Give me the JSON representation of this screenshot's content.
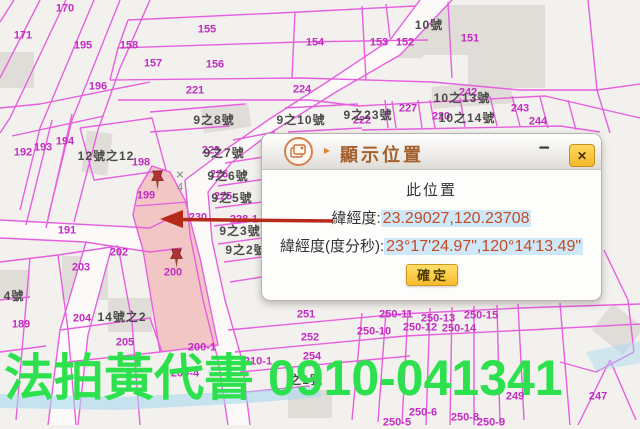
{
  "dialog": {
    "title": "顯示位置",
    "title_arrow_glyph": "▸",
    "icon": "show-position-icon",
    "minimize_glyph": "−",
    "close_glyph": "✕",
    "body": {
      "heading": "此位置",
      "latlng_label": "緯經度:",
      "latlng_value": "23.29027,120.23708",
      "dms_label": "緯經度(度分秒):",
      "dms_value": "23°17'24.97\",120°14'13.49\"",
      "confirm_label": "確定"
    }
  },
  "ad_banner": {
    "text": "法拍黃代書 0910-041341",
    "color": "#2de14e"
  },
  "map": {
    "colors": {
      "parcel_line": "#e65fdf",
      "parcel_number": "#c32cc3",
      "house_label": "#4a4a4a",
      "selected_parcel_fill": "#f3c6c6",
      "river": "#a8d8f0",
      "building": "#e0ddd9",
      "arrow": "#b52a18"
    },
    "road_marker": {
      "x": 180,
      "y": 182,
      "top": "✕",
      "bottom": "4"
    },
    "pins": [
      {
        "x": 157,
        "y": 183
      },
      {
        "x": 176,
        "y": 261
      }
    ],
    "labels": [
      {
        "t": "170",
        "x": 65,
        "y": 9,
        "k": "p"
      },
      {
        "t": "171",
        "x": 23,
        "y": 36,
        "k": "p"
      },
      {
        "t": "195",
        "x": 83,
        "y": 46,
        "k": "p"
      },
      {
        "t": "158",
        "x": 129,
        "y": 46,
        "k": "p"
      },
      {
        "t": "157",
        "x": 153,
        "y": 64,
        "k": "p"
      },
      {
        "t": "196",
        "x": 98,
        "y": 87,
        "k": "p"
      },
      {
        "t": "155",
        "x": 207,
        "y": 30,
        "k": "p"
      },
      {
        "t": "156",
        "x": 215,
        "y": 65,
        "k": "p"
      },
      {
        "t": "154",
        "x": 315,
        "y": 43,
        "k": "p"
      },
      {
        "t": "153",
        "x": 379,
        "y": 43,
        "k": "p"
      },
      {
        "t": "152",
        "x": 405,
        "y": 43,
        "k": "p"
      },
      {
        "t": "151",
        "x": 470,
        "y": 39,
        "k": "p"
      },
      {
        "t": "221",
        "x": 195,
        "y": 91,
        "k": "p"
      },
      {
        "t": "224",
        "x": 302,
        "y": 90,
        "k": "p"
      },
      {
        "t": "227",
        "x": 408,
        "y": 109,
        "k": "p"
      },
      {
        "t": "242",
        "x": 468,
        "y": 93,
        "k": "p"
      },
      {
        "t": "243",
        "x": 520,
        "y": 109,
        "k": "p"
      },
      {
        "t": "244",
        "x": 538,
        "y": 122,
        "k": "p"
      },
      {
        "t": "222",
        "x": 362,
        "y": 121,
        "k": "p"
      },
      {
        "t": "220",
        "x": 441,
        "y": 117,
        "k": "p"
      },
      {
        "t": "192",
        "x": 23,
        "y": 153,
        "k": "p"
      },
      {
        "t": "193",
        "x": 43,
        "y": 148,
        "k": "p"
      },
      {
        "t": "194",
        "x": 65,
        "y": 142,
        "k": "p"
      },
      {
        "t": "198",
        "x": 141,
        "y": 163,
        "k": "p"
      },
      {
        "t": "199",
        "x": 146,
        "y": 196,
        "k": "p"
      },
      {
        "t": "191",
        "x": 67,
        "y": 231,
        "k": "p"
      },
      {
        "t": "202",
        "x": 119,
        "y": 253,
        "k": "p"
      },
      {
        "t": "203",
        "x": 81,
        "y": 268,
        "k": "p"
      },
      {
        "t": "204",
        "x": 82,
        "y": 319,
        "k": "p"
      },
      {
        "t": "205",
        "x": 125,
        "y": 343,
        "k": "p"
      },
      {
        "t": "189",
        "x": 21,
        "y": 325,
        "k": "p"
      },
      {
        "t": "200",
        "x": 173,
        "y": 273,
        "k": "p"
      },
      {
        "t": "200-1",
        "x": 202,
        "y": 348,
        "k": "p"
      },
      {
        "t": "200-4",
        "x": 185,
        "y": 374,
        "k": "p"
      },
      {
        "t": "210-1",
        "x": 258,
        "y": 362,
        "k": "p"
      },
      {
        "t": "251",
        "x": 306,
        "y": 315,
        "k": "p"
      },
      {
        "t": "252",
        "x": 310,
        "y": 338,
        "k": "p"
      },
      {
        "t": "254",
        "x": 312,
        "y": 357,
        "k": "p"
      },
      {
        "t": "250-10",
        "x": 374,
        "y": 332,
        "k": "p"
      },
      {
        "t": "250-11",
        "x": 396,
        "y": 315,
        "k": "p"
      },
      {
        "t": "250-12",
        "x": 420,
        "y": 328,
        "k": "p"
      },
      {
        "t": "250-13",
        "x": 438,
        "y": 319,
        "k": "p"
      },
      {
        "t": "250-14",
        "x": 459,
        "y": 329,
        "k": "p"
      },
      {
        "t": "250-15",
        "x": 481,
        "y": 316,
        "k": "p"
      },
      {
        "t": "250-6",
        "x": 423,
        "y": 413,
        "k": "p"
      },
      {
        "t": "250-5",
        "x": 397,
        "y": 423,
        "k": "p"
      },
      {
        "t": "250-8",
        "x": 465,
        "y": 418,
        "k": "p"
      },
      {
        "t": "250-9",
        "x": 491,
        "y": 423,
        "k": "p"
      },
      {
        "t": "249",
        "x": 515,
        "y": 397,
        "k": "p"
      },
      {
        "t": "247",
        "x": 598,
        "y": 397,
        "k": "p"
      },
      {
        "t": "230",
        "x": 198,
        "y": 218,
        "k": "p"
      },
      {
        "t": "228-1",
        "x": 244,
        "y": 220,
        "k": "p"
      },
      {
        "t": "229",
        "x": 211,
        "y": 151,
        "k": "p"
      },
      {
        "t": "226",
        "x": 219,
        "y": 175,
        "k": "p"
      },
      {
        "t": "225",
        "x": 223,
        "y": 197,
        "k": "p"
      },
      {
        "t": "10號",
        "x": 429,
        "y": 25,
        "k": "h"
      },
      {
        "t": "12號之12",
        "x": 106,
        "y": 156,
        "k": "h"
      },
      {
        "t": "9之8號",
        "x": 214,
        "y": 120,
        "k": "h"
      },
      {
        "t": "9之10號",
        "x": 301,
        "y": 120,
        "k": "h"
      },
      {
        "t": "9之23號",
        "x": 368,
        "y": 115,
        "k": "h"
      },
      {
        "t": "10之13號",
        "x": 462,
        "y": 98,
        "k": "h"
      },
      {
        "t": "10之14號",
        "x": 467,
        "y": 118,
        "k": "h"
      },
      {
        "t": "9之7號",
        "x": 224,
        "y": 153,
        "k": "h"
      },
      {
        "t": "9之6號",
        "x": 228,
        "y": 176,
        "k": "h"
      },
      {
        "t": "9之5號",
        "x": 232,
        "y": 198,
        "k": "h"
      },
      {
        "t": "9之3號",
        "x": 240,
        "y": 231,
        "k": "h"
      },
      {
        "t": "9之2號",
        "x": 246,
        "y": 250,
        "k": "h"
      },
      {
        "t": "14號之2",
        "x": 122,
        "y": 317,
        "k": "h"
      },
      {
        "t": "4號",
        "x": 14,
        "y": 296,
        "k": "h"
      },
      {
        "t": "之1號",
        "x": 306,
        "y": 380,
        "k": "h"
      }
    ]
  }
}
